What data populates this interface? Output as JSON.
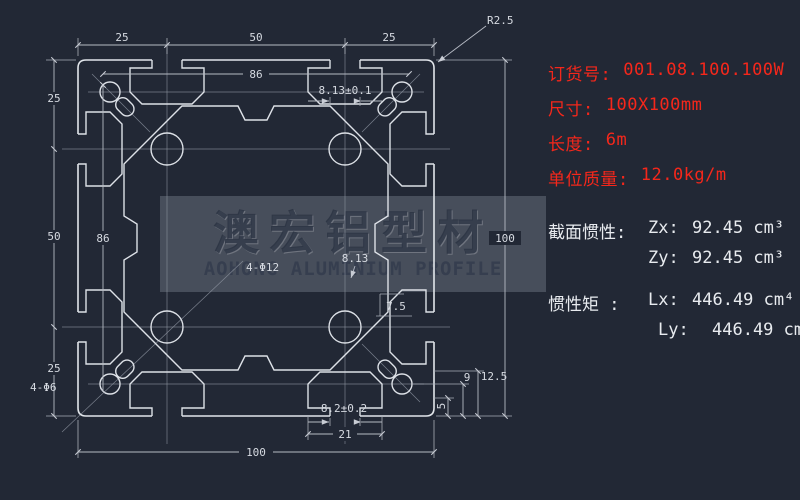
{
  "background": "#222835",
  "drawing": {
    "dims": {
      "chain": [
        "25",
        "50",
        "25"
      ],
      "inner": "86",
      "overall": "100",
      "slot_opening_top": "8.13±0.1",
      "slot_opening_mid": "8.13",
      "slot_depth": "7.5",
      "corner_radius": "R2.5",
      "holes_center": "4-Φ12",
      "holes_corner": "4-Φ6",
      "bottom_opening": "8.2±0.2",
      "bottom_width": "21",
      "depth_a": "12.5",
      "depth_b": "9",
      "depth_c": "5"
    },
    "watermark": {
      "cn": "澳宏铝型材",
      "en": "AOHONG ALUMINIUM PROFILE"
    }
  },
  "panel": {
    "accent_red": "#f5271b",
    "text_white": "#e8ebef",
    "specs": [
      {
        "label": "订货号:",
        "value": "001.08.100.100W"
      },
      {
        "label": "尺寸:",
        "value": "100X100mm"
      },
      {
        "label": "长度:",
        "value": "6m"
      },
      {
        "label": "单位质量:",
        "value": "12.0kg/m"
      }
    ],
    "section": {
      "label": "截面惯性:",
      "rows": [
        {
          "k": "Zx:",
          "v": "92.45 cm³"
        },
        {
          "k": "Zy:",
          "v": "92.45 cm³"
        }
      ]
    },
    "inertia": {
      "label": "惯性矩 :",
      "rows": [
        {
          "k": "Lx:",
          "v": "446.49 cm⁴"
        },
        {
          "k": "Ly:",
          "v": "446.49 cm⁴"
        }
      ]
    }
  }
}
